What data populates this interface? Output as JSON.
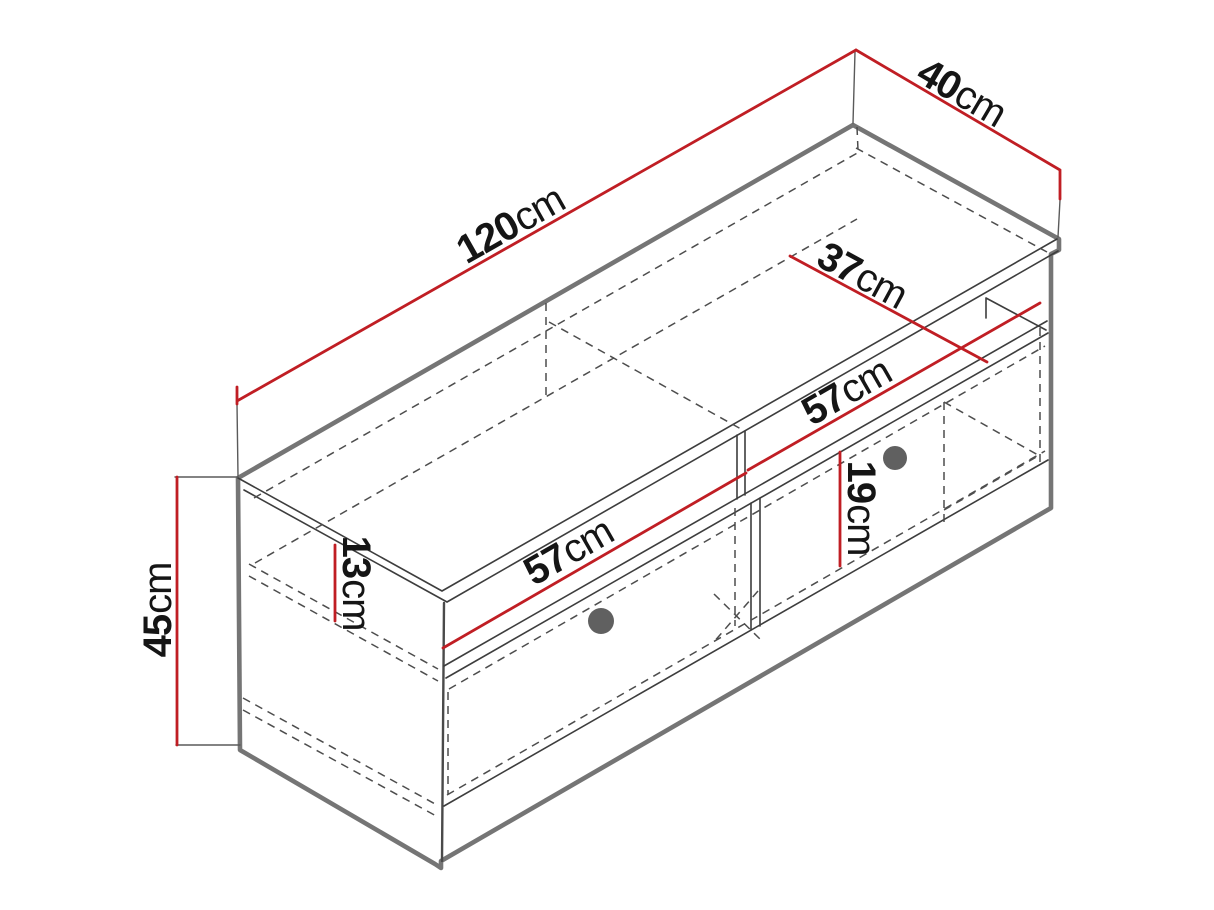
{
  "diagram": {
    "type": "furniture-dimension-drawing",
    "subject": "TV cabinet with open niche and two drawers, isometric view",
    "unit": "cm",
    "colors": {
      "dimension_line": "#C01E24",
      "outline": "#757575",
      "inner_line": "#3d3d3d",
      "knob": "#606060",
      "label": "#151515",
      "background": "#ffffff"
    },
    "dimensions": {
      "width": {
        "value": "120",
        "unit": "cm"
      },
      "depth": {
        "value": "40",
        "unit": "cm"
      },
      "height": {
        "value": "45",
        "unit": "cm"
      },
      "inner_depth": {
        "value": "37",
        "unit": "cm"
      },
      "niche_width": {
        "value": "57",
        "unit": "cm"
      },
      "drawer_width": {
        "value": "57",
        "unit": "cm"
      },
      "niche_height": {
        "value": "13",
        "unit": "cm"
      },
      "drawer_height": {
        "value": "19",
        "unit": "cm"
      }
    },
    "knob_count": 2
  }
}
